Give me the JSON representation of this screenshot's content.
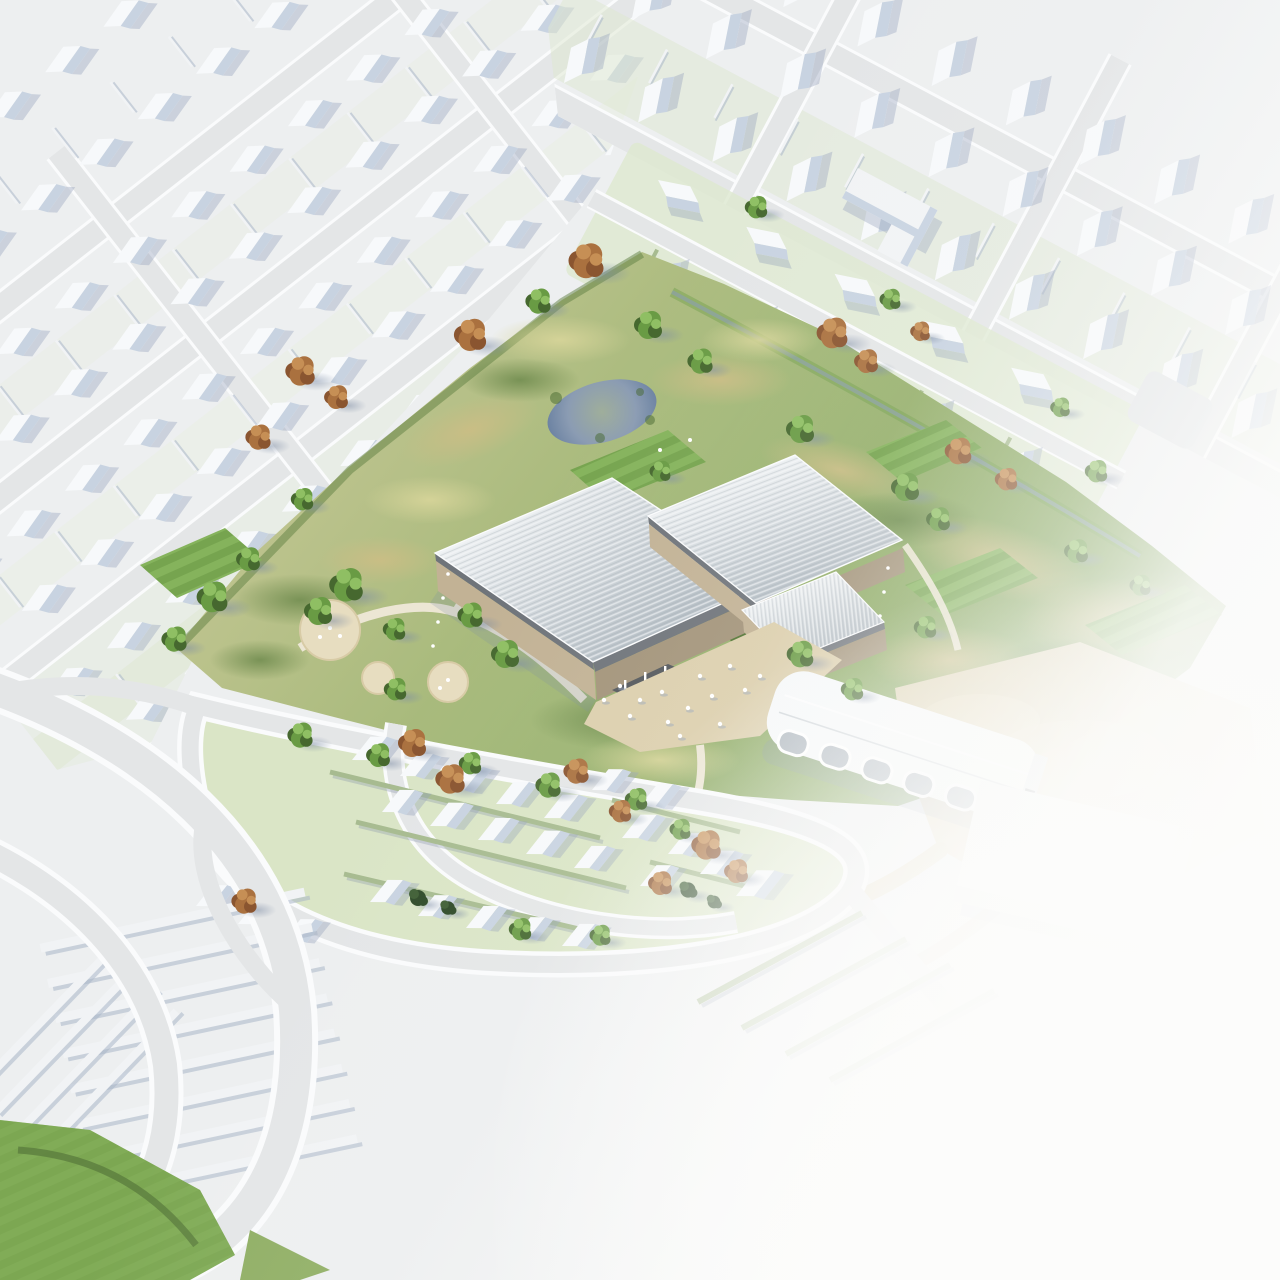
{
  "scene": {
    "type": "aerial-architectural-site-rendering",
    "subject": "leisure-centre-in-park-surrounded-by-white-massing-housing",
    "visible_elements": [
      "white massing-model housing districts with gabled roofs",
      "diagonal suburban streets with white kerbs",
      "central wildflower park with pond",
      "three halls with ribbed silver metal roofs and beige stone walls",
      "green roofs between halls",
      "entrance plaza with pedestrian figures",
      "existing white barrel-vaulted sports hall with arched glazing",
      "plain white utility building",
      "sand coloured esplanade and paths",
      "housing estate with green gardens and hedgerows",
      "green and russet autumn trees",
      "striped mown lawns",
      "curved roads in the south west",
      "white fog fading the lower right corner"
    ]
  },
  "colors": {
    "bg": "#edeff0",
    "road": "#e4e6e7",
    "curb": "#fafbfc",
    "houseTop": "#f7f9fb",
    "houseShade": "#c8d3e1",
    "houseShadow": "#92a1ba",
    "wallLight": "#f1f3f5",
    "wallShadow": "#a9b6c9",
    "hedge": "#a7bb90",
    "gardenTint": "#e9eee3",
    "gardenTintGreen": "#dde8d0",
    "estateGround": "#d8e4c2",
    "meadow1": "#c6c795",
    "meadow2": "#a3b878",
    "meadow3": "#7fa258",
    "patchTan": "#cdbd85",
    "patchDark": "#5f7f41",
    "patchLight": "#d8d59a",
    "lawnA": "#85b35c",
    "lawnB": "#76a44f",
    "lawnCorner": "#7fa854",
    "pondDeep": "#647c9e",
    "pondMid": "#8b9cb3",
    "pondShallow": "#9fae9b",
    "treeDark": "#46682f",
    "treeMid": "#699b44",
    "treeLight": "#8fbf63",
    "rusDark": "#8a5530",
    "rusMid": "#aa713f",
    "rusLight": "#c68f55",
    "coniferDark": "#2e4a28",
    "coniferMid": "#3f5f35",
    "trunk": "#6f665a",
    "shadowBlue": "#7d8ca4",
    "roofHi": "#eceff1",
    "roofLo": "#b3bcc3",
    "ribLine": "#f6f8f9",
    "ribDark": "#9aa3aa",
    "wallBeige": "#c2b295",
    "wallBeigeDark": "#a3947a",
    "glass": "#6f747a",
    "greenRoof": "#4f7231",
    "plaza": "#dccfad",
    "esplanade": "#e0d4b5",
    "pathBeige": "#ece6d4",
    "hallHi": "#f6f8f9",
    "hallLo": "#d5dce1",
    "glassHall": "#aab3bb",
    "boxTop": "#f3f5f6",
    "boxSide": "#d6dce2",
    "boxFront": "#e7ebee",
    "fogWhite": "#fcfcfb"
  }
}
